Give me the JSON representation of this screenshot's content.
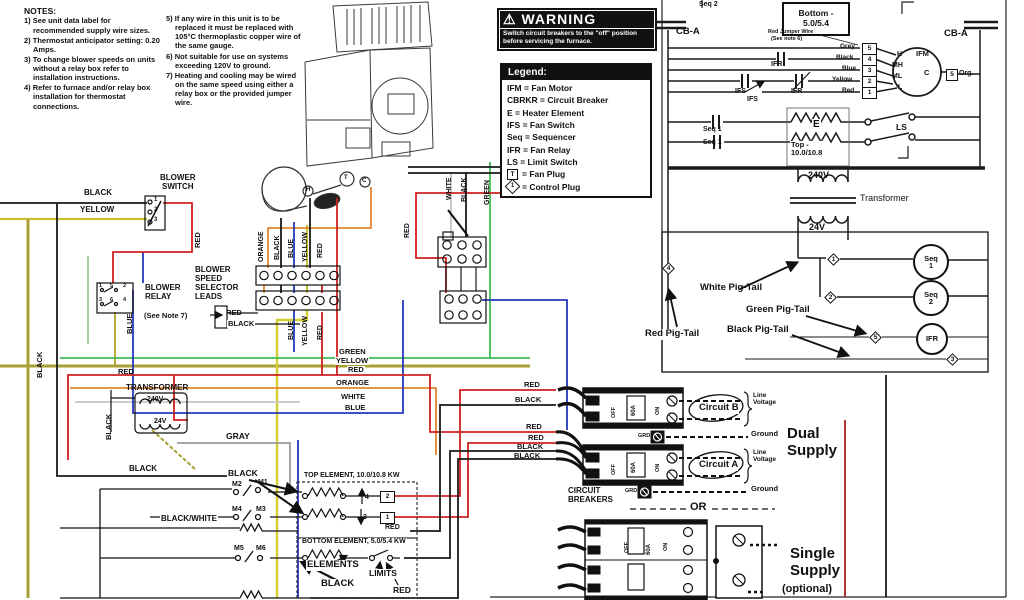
{
  "notes": {
    "title": "NOTES:",
    "col1": [
      "1) See unit data label for recommended supply wire sizes.",
      "2) Thermostat anticipator setting: 0.20 Amps.",
      "3) To change blower speeds on units without a relay box refer to installation instructions.",
      "4) Refer to furnace and/or relay box installation for thermostat connections."
    ],
    "col2": [
      "5) If any wire in this unit is to be replaced it must be replaced with 105°C thermoplastic copper wire of the same gauge.",
      "6) Not suitable for use on systems exceeding 120V to ground.",
      "7) Heating and cooling may be wired on the same speed using either a relay box or the provided jumper wire."
    ]
  },
  "warning": {
    "icon": "⚠",
    "title": "WARNING",
    "body": "Switch circuit breakers to the \"off\" position before servicing the furnace."
  },
  "legend": {
    "title": "Legend:",
    "entries": [
      "IFM = Fan Motor",
      "CBRKR = Circuit Breaker",
      "E = Heater Element",
      "IFS = Fan Switch",
      "Seq = Sequencer",
      "IFR = Fan Relay",
      "LS = Limit Switch"
    ],
    "fan_plug_sym": "T",
    "fan_plug": "= Fan Plug",
    "control_plug_sym": "1",
    "control_plug": "= Control Plug"
  },
  "ladder": {
    "seq2_top": "Seq 2",
    "bottom_box": "Bottom -\n5.0/5.4",
    "cba_left": "CB-A",
    "cba_right": "CB-A",
    "jumper": "Red Jumper Wire",
    "jumper_note": "(See note 6)",
    "grey": "Grey",
    "black": "Black",
    "blue": "Blue",
    "yellow": "Yellow",
    "red": "Red",
    "t5": "5",
    "t4": "4",
    "t3": "3",
    "t2": "2",
    "t1": "1",
    "ifm": "IFM",
    "h": "H",
    "mh": "MH",
    "ml": "ML",
    "l": "L",
    "c": "C",
    "plug": "5",
    "org": "Org.",
    "ifr_a": "IFR",
    "ifr_b": "IFR",
    "ifs_a": "IFS",
    "ifs_b": "IFS",
    "seq1_a": "Seq 1",
    "seq1_b": "Seq 1",
    "e": "E",
    "top_rating": "Top -\n10.0/10.8",
    "ls": "LS",
    "v240": "240V",
    "transformer": "Transformer",
    "v24": "24V"
  },
  "pigtails": {
    "white": "White Pig-Tail",
    "green": "Green Pig-Tail",
    "black": "Black Pig-Tail",
    "red": "Red Pig-Tail",
    "seq1": "Seq\n1",
    "seq2": "Seq\n2",
    "ifr": "IFR",
    "d1": "1",
    "d2": "2",
    "d3": "3",
    "d4": "4",
    "d5": "5"
  },
  "supply": {
    "feedB": [
      "RED",
      "BLACK"
    ],
    "feedA": [
      "RED",
      "RED",
      "BLACK",
      "BLACK"
    ],
    "circuit_b": "Circuit B",
    "circuit_a": "Circuit A",
    "line_voltage": "Line\nVoltage",
    "ground": "Ground",
    "grd": "GRD",
    "amp": "60A",
    "off": "OFF",
    "on": "ON",
    "dual": "Dual\nSupply",
    "or_label": "OR",
    "breakers_label": "CIRCUIT\nBREAKERS",
    "single": "Single\nSupply",
    "optional": "(optional)"
  },
  "center": {
    "blower_switch": "BLOWER\nSWITCH",
    "sw": [
      "1",
      "2",
      "3"
    ],
    "blower_relay": "BLOWER\nRELAY",
    "relay_t": [
      "1",
      "3",
      "5",
      "2",
      "6",
      "4"
    ],
    "speed_leads": "BLOWER\nSPEED\nSELECTOR\nLEADS",
    "see_note": "(See Note 7)",
    "lead_red": "RED",
    "lead_black": "BLACK",
    "feed_black": "BLACK",
    "feed_yellow": "YELLOW",
    "v_red": "RED",
    "v_blue": "BLUE",
    "conn_orange": "ORANGE",
    "conn_black": "BLACK",
    "conn_blue": "BLUE",
    "conn_yellow": "YELLOW",
    "conn_red": "RED",
    "out_blue": "BLUE",
    "out_yellow": "YELLOW",
    "out_red": "RED",
    "rt_red": "RED",
    "rt_white": "WHITE",
    "rt_black": "BLACK",
    "rt_green": "GREEN",
    "row_green": "GREEN",
    "row_yellow": "YELLOW",
    "row_red": "RED",
    "row_orange": "ORANGE",
    "row_white": "WHITE",
    "row_blue": "BLUE",
    "gray": "GRAY",
    "transformer": "TRANSFORMER",
    "v240": "240V",
    "v24": "24V",
    "red_xfmr": "RED",
    "black_left": "BLACK",
    "black_xfmr": "BLACK",
    "black_a": "BLACK",
    "black_b": "BLACK",
    "black_white": "BLACK/WHITE",
    "m": [
      "M1",
      "M2",
      "M3",
      "M4",
      "M5",
      "M6"
    ],
    "top_element": "TOP ELEMENT, 10.0/10.8 KW",
    "bottom_element": "BOTTOM ELEMENT, 5.0/5.4 KW",
    "n4": "4",
    "n3": "3",
    "n2": "2",
    "n1": "1",
    "red_plug": "RED",
    "elements": "ELEMENTS",
    "limits": "LIMITS",
    "black_btm": "BLACK",
    "red_btm": "RED",
    "motor_t": "T",
    "motor_c": "C",
    "motor_h": "H"
  }
}
